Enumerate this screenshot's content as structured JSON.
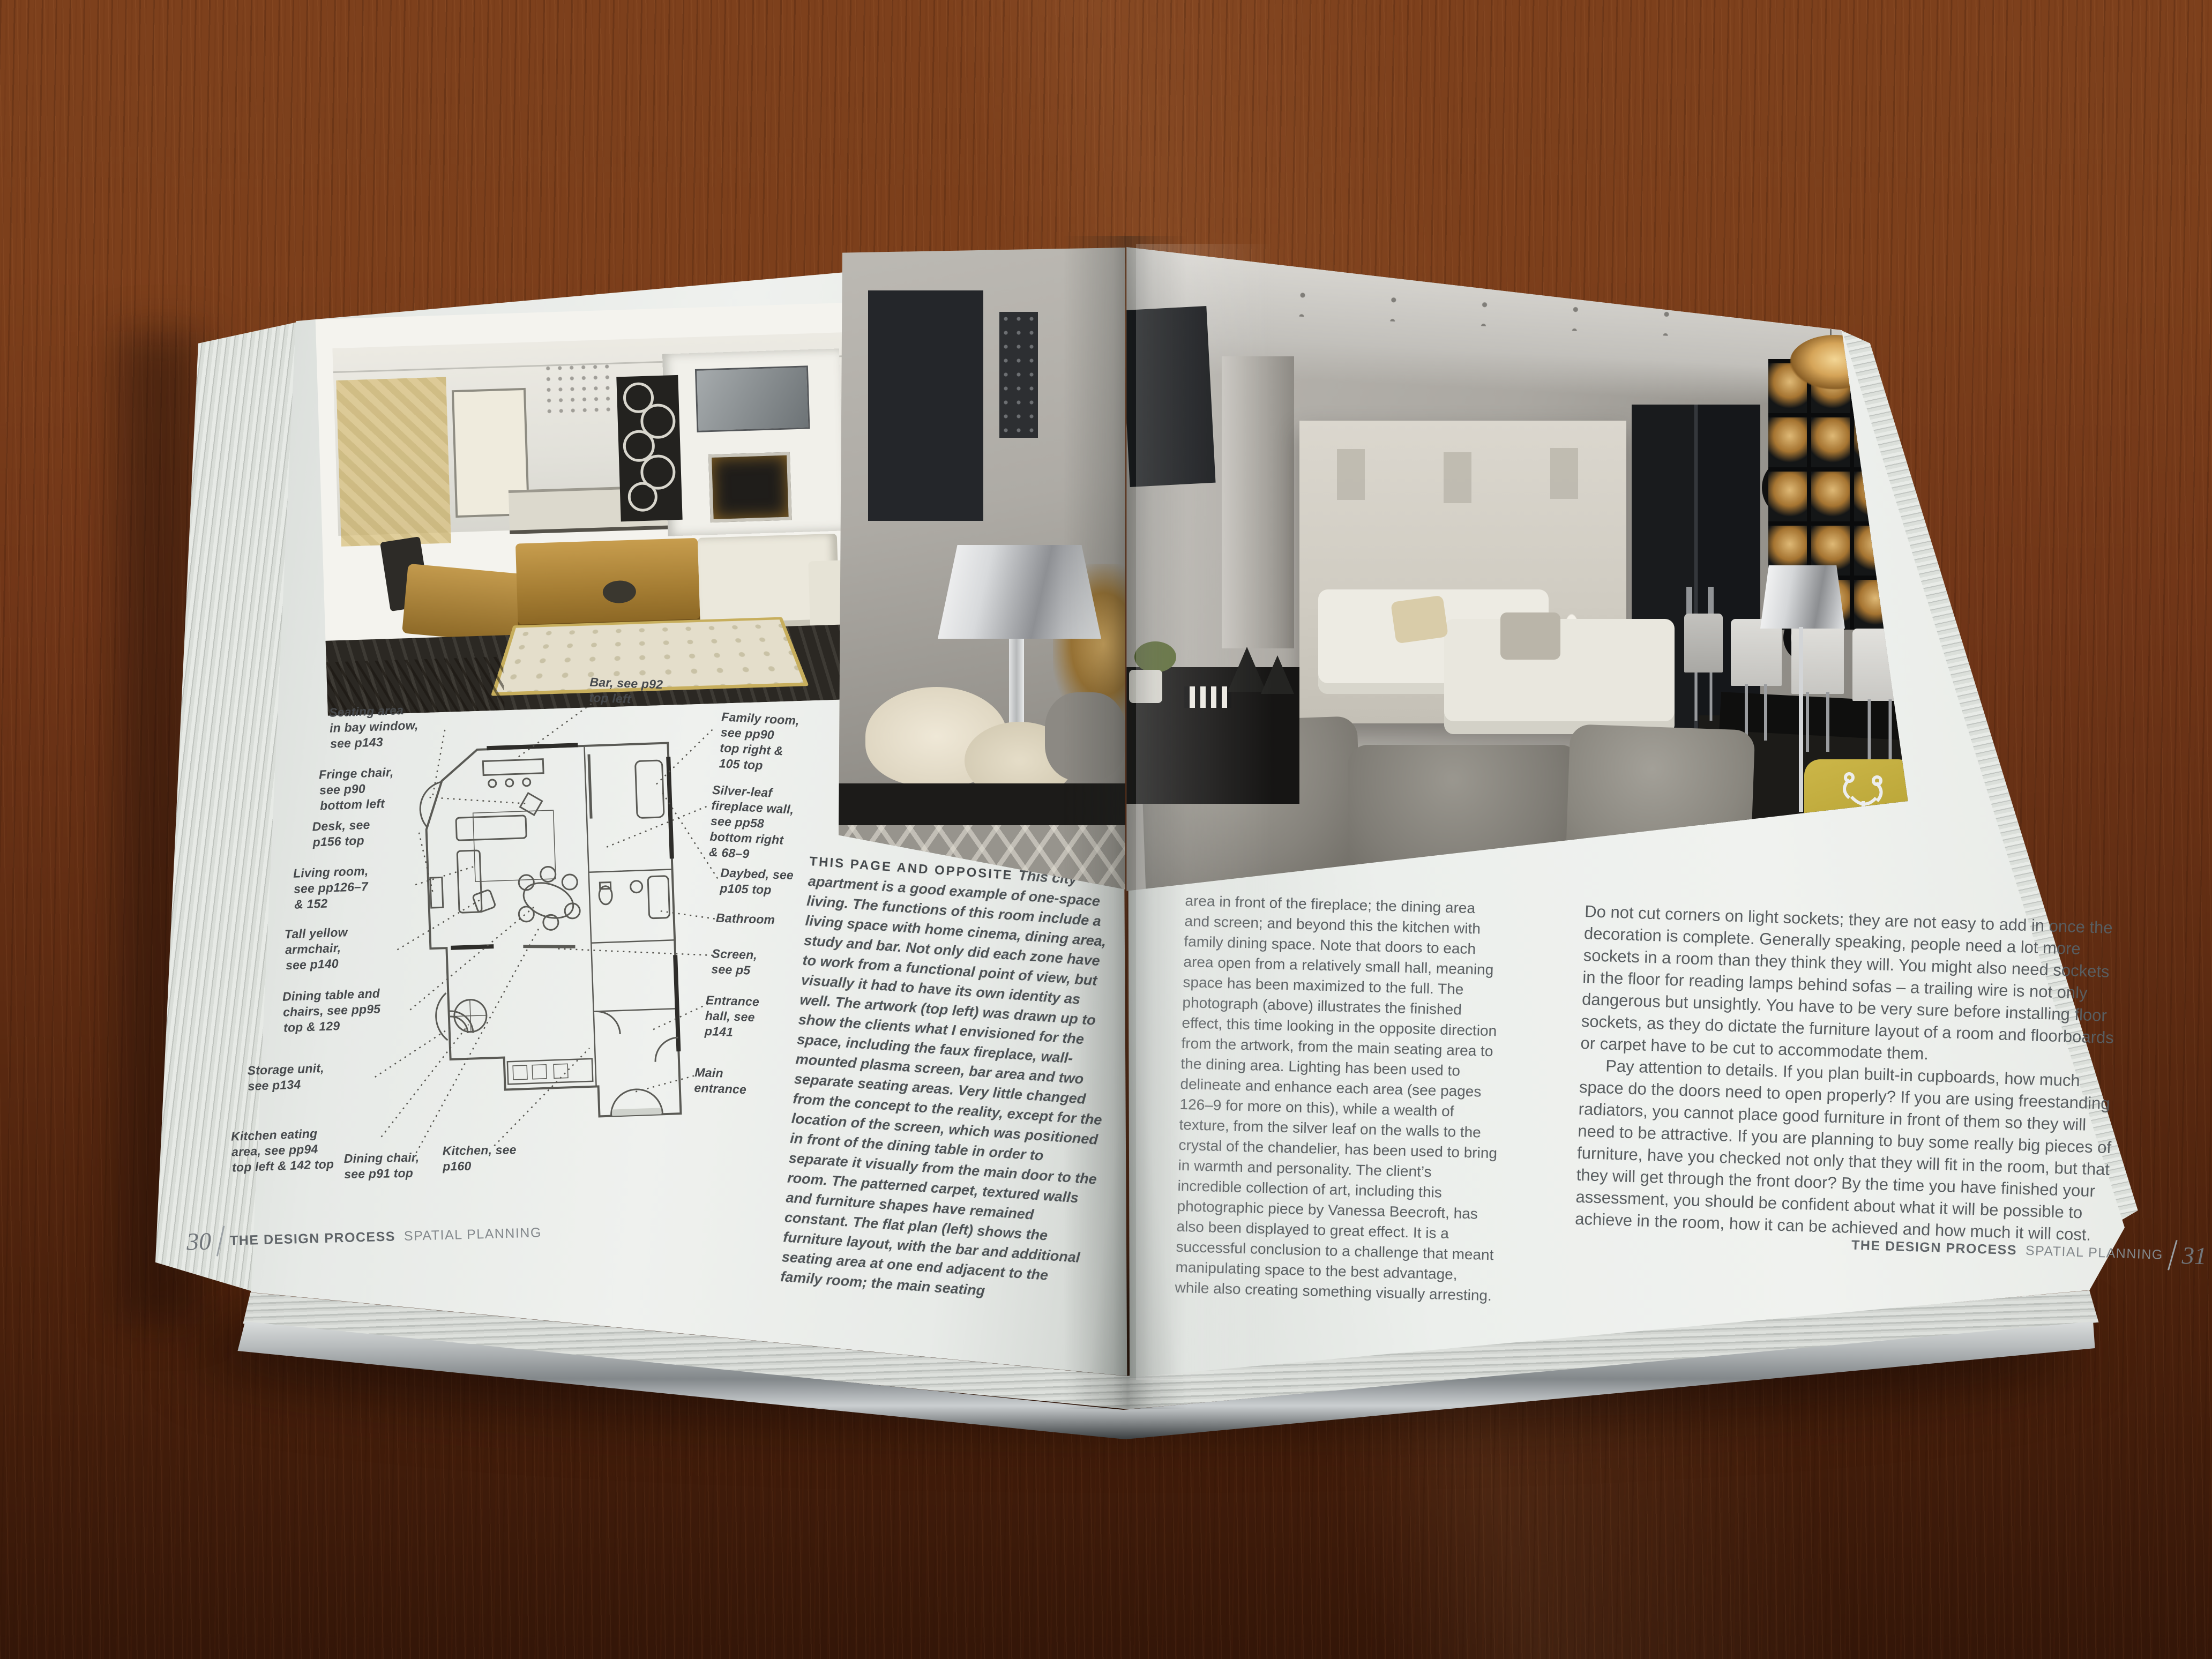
{
  "book": {
    "left_page": {
      "caption": {
        "lead_in": "THIS PAGE AND OPPOSITE",
        "body": "This city apartment is a good example of one-space living. The functions of this room include a living space with home cinema, dining area, study and bar. Not only did each zone have to work from a functional point of view, but visually it had to have its own identity as well. The artwork (top left) was drawn up to show the clients what I envisioned for the space, including the faux fireplace, wall-mounted plasma screen, bar area and two separate seating areas. Very little changed from the concept to the reality, except for the location of the screen, which was positioned in front of the dining table in order to separate it visually from the main door to the room. The patterned carpet, textured walls and furniture shapes have remained constant. The flat plan (left) shows the furniture layout, with the bar and additional seating area at one end adjacent to the family room; the main seating"
      },
      "floor_plan": {
        "labels": [
          "Seating area\nin bay window,\nsee p143",
          "Fringe chair,\nsee p90\nbottom left",
          "Desk, see\np156 top",
          "Living room,\nsee pp126–7\n& 152",
          "Tall yellow\narmchair,\nsee p140",
          "Dining table and\nchairs, see pp95\ntop & 129",
          "Storage unit,\nsee p134",
          "Kitchen eating\narea, see pp94\ntop left & 142 top",
          "Dining chair,\nsee p91 top",
          "Kitchen, see\np160",
          "Bar, see p92\ntop left",
          "Family room,\nsee pp90\ntop right &\n105 top",
          "Silver-leaf\nfireplace wall,\nsee pp58\nbottom right\n& 68–9",
          "Daybed, see\np105 top",
          "Bathroom",
          "Screen,\nsee p5",
          "Entrance\nhall, see\np141",
          "Main\nentrance"
        ]
      },
      "footer": {
        "page_number": "30",
        "section": "THE DESIGN PROCESS",
        "subsection": "SPATIAL PLANNING"
      }
    },
    "right_page": {
      "column_1": "area in front of the fireplace; the dining area and screen; and beyond this the kitchen with family dining space. Note that doors to each area open from a relatively small hall, meaning space has been maximized to the full. The photograph (above) illustrates the finished effect, this time looking in the opposite direction from the artwork, from the main seating area to the dining area. Lighting has been used to delineate and enhance each area (see pages 126–9 for more on this), while a wealth of texture, from the silver leaf on the walls to the crystal of the chandelier, has been used to bring in warmth and personality. The client’s incredible collection of art, including this photographic piece by Vanessa Beecroft, has also been displayed to great effect. It is a successful conclusion to a challenge that meant manipulating space to the best advantage, while also creating something visually arresting.",
      "column_2": {
        "paragraph_1": "Do not cut corners on light sockets; they are not easy to add in once the decoration is complete. Generally speaking, people need a lot more sockets in a room than they think they will. You might also need sockets in the floor for reading lamps behind sofas – a trailing wire is not only dangerous but unsightly. You have to be very sure before installing floor sockets, as they do dictate the furniture layout of a room and floorboards or carpet have to be cut to accommodate them.",
        "paragraph_2": "Pay attention to details. If you plan built-in cupboards, how much space do the doors need to open properly? If you are using freestanding radiators, you cannot place good furniture in front of them so they will need to be attractive. If you are planning to buy some really big pieces of furniture, have you checked not only that they will fit in the room, but that they will get through the front door? By the time you have finished your assessment, you should be confident about what it will be possible to achieve in the room, how it can be achieved and how much it will cost."
      },
      "footer": {
        "page_number": "31",
        "section": "THE DESIGN PROCESS",
        "subsection": "SPATIAL PLANNING"
      }
    }
  },
  "colors": {
    "table_wood": "#6e3517",
    "page_paper": "#eceeeb",
    "print_text": "#585d60",
    "gold_sofa": "#bb923f",
    "yellow_chair": "#c2ab3d",
    "chandelier_gold": "#d9a657",
    "velvet_grey": "#8f8c85"
  }
}
